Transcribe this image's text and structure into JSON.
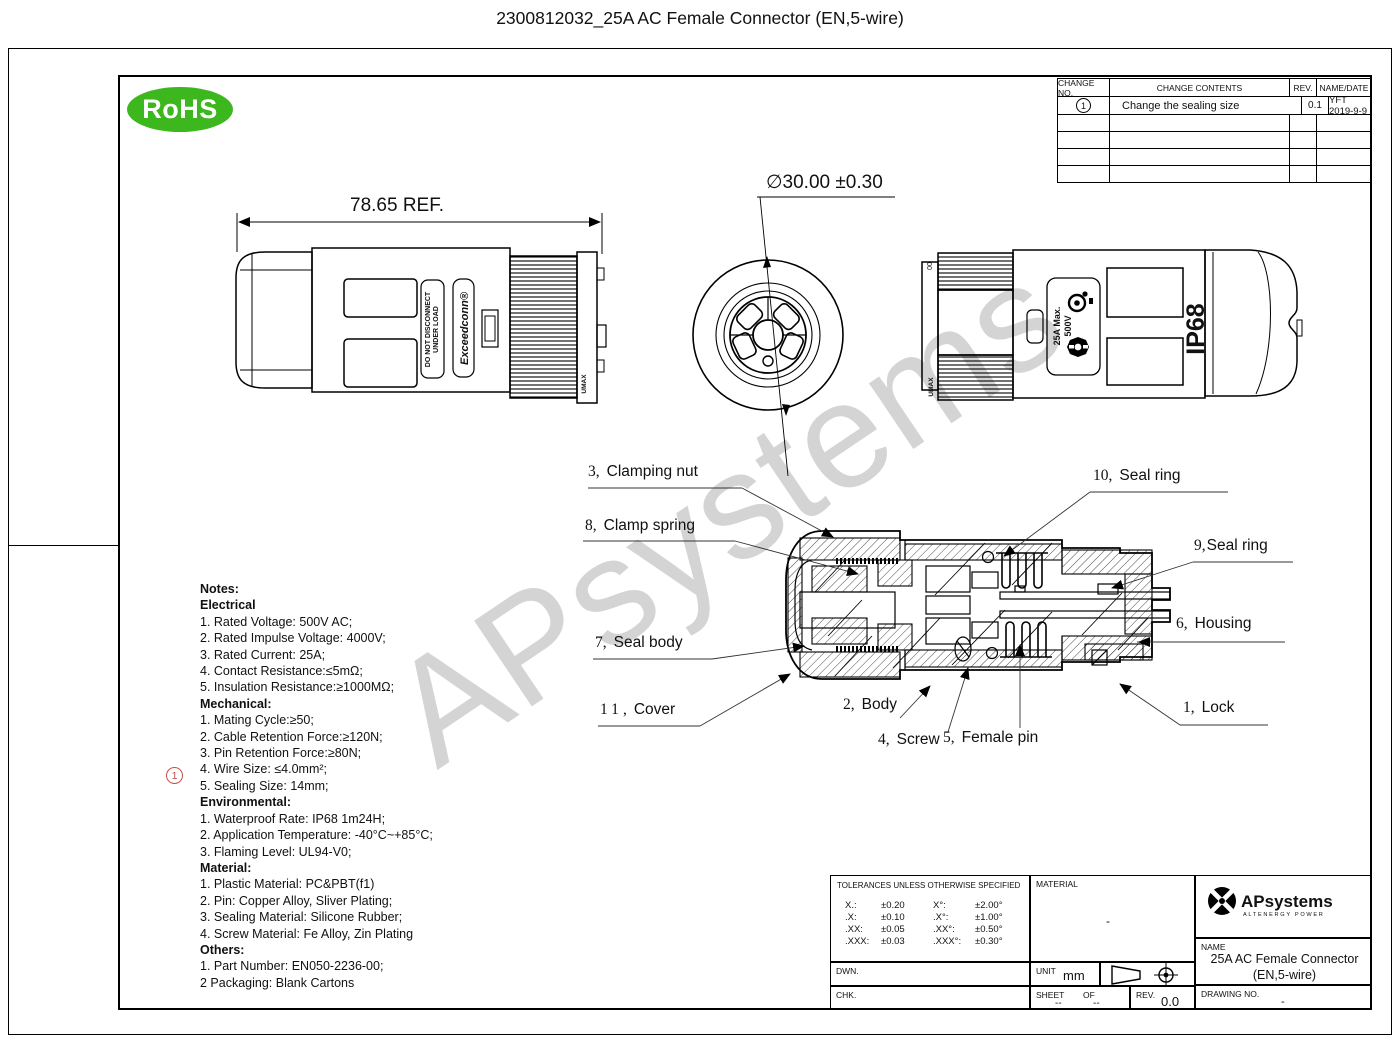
{
  "page": {
    "title": "2300812032_25A AC Female Connector (EN,5-wire)",
    "watermark": "APsystems"
  },
  "rohs_badge": {
    "label": "RoHS",
    "color": "#3cb71d"
  },
  "change_table": {
    "headers": [
      "CHANGE NO.",
      "CHANGE CONTENTS",
      "REV.",
      "NAME/DATE"
    ],
    "rows": [
      {
        "no": "1",
        "contents": "Change the sealing size",
        "rev": "0.1",
        "name_date": "YFT 2019-9-9"
      }
    ]
  },
  "dimensions": {
    "length_ref": "78.65  REF.",
    "diameter": "∅30.00 ±0.30"
  },
  "connector_markings": {
    "warning_line1": "DO NOT DISCONNECT",
    "warning_line2": "UNDER LOAD",
    "brand": "Exceedconn®",
    "side_marking": "UMAX",
    "rating_line1": "25A Max.",
    "rating_line2": "500V",
    "ip_rating": "IP68",
    "end_marking": "00"
  },
  "section": {
    "separator": ","
  },
  "parts": [
    {
      "no": "3",
      "name": "Clamping nut"
    },
    {
      "no": "8",
      "name": "Clamp spring"
    },
    {
      "no": "10",
      "name": "Seal ring"
    },
    {
      "no": "9",
      "name": "Seal ring"
    },
    {
      "no": "6",
      "name": "Housing"
    },
    {
      "no": "7",
      "name": "Seal body"
    },
    {
      "no": "11",
      "name": "Cover"
    },
    {
      "no": "2",
      "name": "Body"
    },
    {
      "no": "4",
      "name": "Screw"
    },
    {
      "no": "5",
      "name": "Female pin"
    },
    {
      "no": "1",
      "name": "Lock"
    }
  ],
  "notes": {
    "title": "Notes:",
    "marker": "1",
    "electrical": {
      "heading": "Electrical",
      "items": [
        "1. Rated Voltage: 500V AC;",
        "2. Rated Impulse Voltage: 4000V;",
        "3. Rated Current: 25A;",
        "4. Contact Resistance:≤5mΩ;",
        "5. Insulation Resistance:≥1000MΩ;"
      ]
    },
    "mechanical": {
      "heading": "Mechanical:",
      "items": [
        "1. Mating Cycle:≥50;",
        "2. Cable Retention Force:≥120N;",
        "3. Pin Retention Force:≥80N;",
        "4. Wire Size: ≤4.0mm²;",
        "5. Sealing Size: 14mm;"
      ]
    },
    "environmental": {
      "heading": "Environmental:",
      "items": [
        "1. Waterproof Rate: IP68 1m24H;",
        "2. Application Temperature: -40°C~+85°C;",
        "3. Flaming Level: UL94-V0;"
      ]
    },
    "material": {
      "heading": "Material:",
      "items": [
        "1. Plastic Material: PC&PBT(f1)",
        "2. Pin: Copper Alloy, Sliver Plating;",
        "3. Sealing Material: Silicone Rubber;",
        "4. Screw Material: Fe Alloy, Zin Plating"
      ]
    },
    "others": {
      "heading": "Others:",
      "items": [
        "1. Part Number: EN050-2236-00;",
        "2  Packaging: Blank Cartons"
      ]
    }
  },
  "title_block": {
    "tolerances": {
      "heading": "TOLERANCES UNLESS OTHERWISE SPECIFIED",
      "rows": [
        {
          "l_label": "X.:",
          "l_val": "±0.20",
          "r_label": "X°:",
          "r_val": "±2.00°"
        },
        {
          "l_label": ".X:",
          "l_val": "±0.10",
          "r_label": ".X°:",
          "r_val": "±1.00°"
        },
        {
          "l_label": ".XX:",
          "l_val": "±0.05",
          "r_label": ".XX°:",
          "r_val": "±0.50°"
        },
        {
          "l_label": ".XXX:",
          "l_val": "±0.03",
          "r_label": ".XXX°:",
          "r_val": "±0.30°"
        }
      ]
    },
    "material": {
      "label": "MATERIAL",
      "value": "-"
    },
    "dwn": {
      "label": "DWN."
    },
    "chk": {
      "label": "CHK."
    },
    "unit": {
      "label": "UNIT",
      "value": "mm"
    },
    "sheet": {
      "label": "SHEET",
      "of_label": "OF",
      "value": "--",
      "of_value": "--"
    },
    "rev": {
      "label": "REV.",
      "value": "0.0"
    },
    "brand": {
      "name": "APsystems",
      "tagline": "ALTENERGY POWER"
    },
    "name": {
      "label": "NAME",
      "value_line1": "25A AC Female Connector",
      "value_line2": "(EN,5-wire)"
    },
    "drawing_no": {
      "label": "DRAWING NO.",
      "value": "-"
    }
  }
}
